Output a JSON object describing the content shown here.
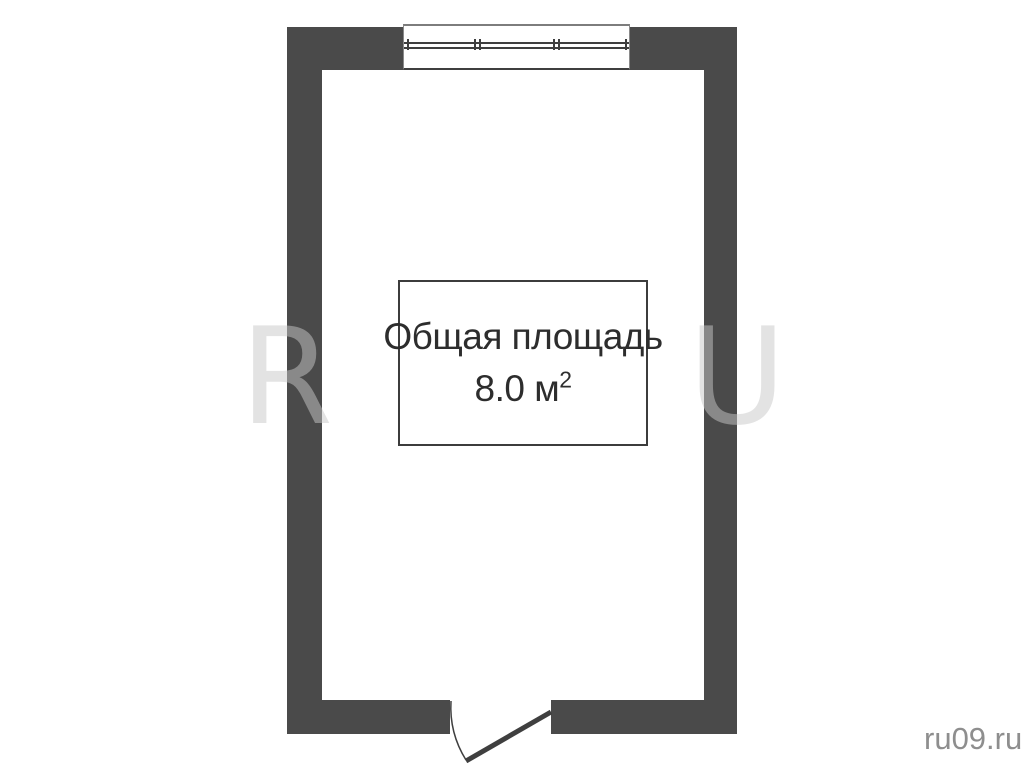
{
  "colors": {
    "wall": "#4a4a4a",
    "plan_line": "#3f3f3f",
    "label_text": "#2d2d2d",
    "watermark_letter": "rgba(200,200,200,0.5)",
    "site_watermark_text": "#8e8e8e"
  },
  "floor_plan": {
    "label_box": {
      "title": "Общая площадь",
      "area_value": "8.0",
      "area_unit": "м",
      "area_superscript": "2"
    }
  },
  "watermark": {
    "letter_left": "R",
    "letter_right": "U",
    "site": "ru09.ru"
  }
}
